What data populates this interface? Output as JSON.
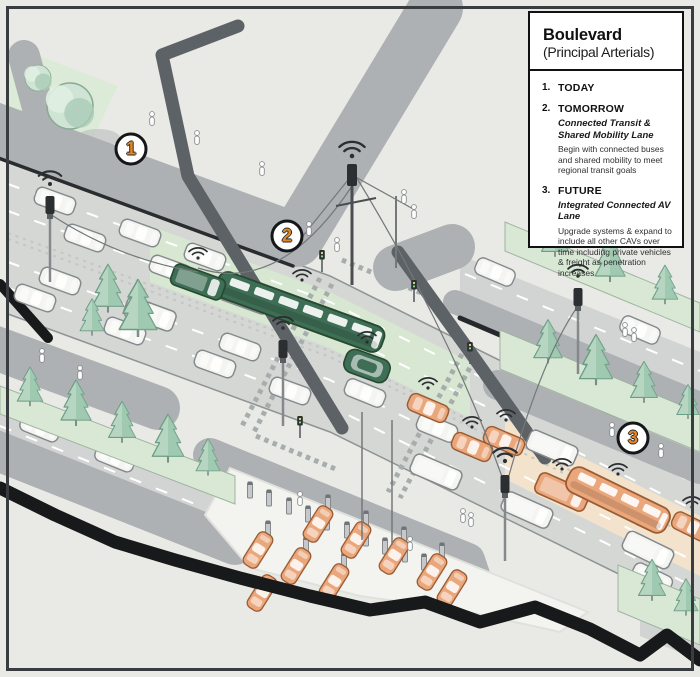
{
  "legend": {
    "title": "Boulevard",
    "subtitle": "(Principal Arterials)",
    "items": [
      {
        "num": "1.",
        "heading": "TODAY",
        "sub": "",
        "body": ""
      },
      {
        "num": "2.",
        "heading": "TOMORROW",
        "sub": "Connected Transit & Shared Mobility Lane",
        "body": "Begin with connected buses and shared mobility to meet regional transit goals"
      },
      {
        "num": "3.",
        "heading": "FUTURE",
        "sub": "Integrated Connected AV Lane",
        "body": "Upgrade systems & expand to include all other CAVs over time including private vehicles & freight as penetration increases"
      }
    ]
  },
  "callouts": [
    {
      "number": "1",
      "phase": "today"
    },
    {
      "number": "2",
      "phase": "tomorrow"
    },
    {
      "number": "3",
      "phase": "future"
    }
  ],
  "colors": {
    "background": "#e9eae5",
    "transit_vehicle_green": "#3e6e55",
    "transit_lane_green": "#d7e7d2",
    "av_vehicle_orange": "#eaa77c",
    "av_lane_peach": "#f3e3cd",
    "today_vehicle_white": "#f4f4f2",
    "callout_number_orange": "#e8871f"
  }
}
